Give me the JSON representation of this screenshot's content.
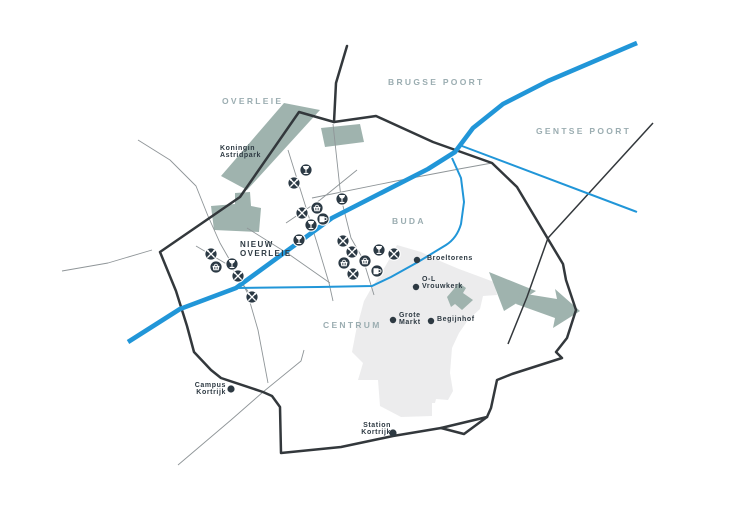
{
  "map": {
    "description": "Stylized district map of Kortrijk with the river Leie, ring roads, parks and points of interest",
    "colors": {
      "bg": "#ffffff",
      "river": "#2196d8",
      "park": "#9fb3ae",
      "ped": "#ececed",
      "road-main": "#33383c",
      "road-thin": "#8f9598",
      "region": "#9badb1",
      "dark": "#2d3942",
      "poi": "#2b3944"
    },
    "regions": [
      {
        "name": "overleie",
        "lines": [
          "OVERLEIE"
        ],
        "x": 222,
        "y": 96,
        "style": "region-label"
      },
      {
        "name": "brugse-poort",
        "lines": [
          "BRUGSE POORT"
        ],
        "x": 388,
        "y": 77,
        "style": "region-label"
      },
      {
        "name": "gentse-poort",
        "lines": [
          "GENTSE POORT"
        ],
        "x": 536,
        "y": 126,
        "style": "region-label"
      },
      {
        "name": "buda",
        "lines": [
          "BUDA"
        ],
        "x": 392,
        "y": 216,
        "style": "region-label"
      },
      {
        "name": "centrum",
        "lines": [
          "CENTRUM"
        ],
        "x": 323,
        "y": 320,
        "style": "region-label"
      },
      {
        "name": "nieuw-overleie",
        "lines": [
          "NIEUW",
          "OVERLEIE"
        ],
        "x": 240,
        "y": 240,
        "style": "district-dark"
      }
    ],
    "landmarks": [
      {
        "name": "koningin-astridpark",
        "lines": [
          "Koningin",
          "Astridpark"
        ],
        "label_x": 220,
        "label_y": 145,
        "align": "left",
        "dot": null
      },
      {
        "name": "broeltorens",
        "lines": [
          "Broeltorens"
        ],
        "label_x": 427,
        "label_y": 255,
        "align": "left",
        "dot": {
          "x": 417,
          "y": 260,
          "r": 3.2
        }
      },
      {
        "name": "o-l-vrouwkerk",
        "lines": [
          "O-L",
          "Vrouwkerk"
        ],
        "label_x": 422,
        "label_y": 276,
        "align": "left",
        "dot": {
          "x": 416,
          "y": 287,
          "r": 3.2
        }
      },
      {
        "name": "grote-markt",
        "lines": [
          "Grote",
          "Markt"
        ],
        "label_x": 399,
        "label_y": 312,
        "align": "left",
        "dot": {
          "x": 393,
          "y": 320,
          "r": 3.2
        }
      },
      {
        "name": "begijnhof",
        "lines": [
          "Begijnhof"
        ],
        "label_x": 437,
        "label_y": 316,
        "align": "left",
        "dot": {
          "x": 431,
          "y": 321,
          "r": 3.2
        }
      },
      {
        "name": "campus-kortrijk",
        "lines": [
          "Campus",
          "Kortrijk"
        ],
        "label_x": 226,
        "label_y": 382,
        "align": "right",
        "dot": {
          "x": 231,
          "y": 389,
          "r": 3.6
        }
      },
      {
        "name": "station-kortrijk",
        "lines": [
          "Station",
          "Kortrijk"
        ],
        "label_x": 391,
        "label_y": 422,
        "align": "right",
        "dot": {
          "x": 393,
          "y": 433,
          "r": 3.6
        }
      }
    ],
    "poi_legend": {
      "restaurant": "crossed-cutlery-icon",
      "bar": "wine-glass-icon",
      "cafe": "beer-mug-icon",
      "shop": "basket-icon"
    },
    "poi_markers": [
      {
        "type": "bar",
        "x": 306,
        "y": 170
      },
      {
        "type": "restaurant",
        "x": 294,
        "y": 183
      },
      {
        "type": "bar",
        "x": 342,
        "y": 199
      },
      {
        "type": "shop",
        "x": 317,
        "y": 208
      },
      {
        "type": "restaurant",
        "x": 302,
        "y": 213
      },
      {
        "type": "cafe",
        "x": 323,
        "y": 219
      },
      {
        "type": "bar",
        "x": 311,
        "y": 225
      },
      {
        "type": "bar",
        "x": 299,
        "y": 240
      },
      {
        "type": "restaurant",
        "x": 211,
        "y": 254
      },
      {
        "type": "bar",
        "x": 232,
        "y": 264
      },
      {
        "type": "shop",
        "x": 216,
        "y": 267
      },
      {
        "type": "restaurant",
        "x": 238,
        "y": 276
      },
      {
        "type": "restaurant",
        "x": 252,
        "y": 297
      },
      {
        "type": "restaurant",
        "x": 343,
        "y": 241
      },
      {
        "type": "restaurant",
        "x": 352,
        "y": 252
      },
      {
        "type": "bar",
        "x": 379,
        "y": 250
      },
      {
        "type": "restaurant",
        "x": 394,
        "y": 254
      },
      {
        "type": "shop",
        "x": 344,
        "y": 263
      },
      {
        "type": "shop",
        "x": 365,
        "y": 261
      },
      {
        "type": "cafe",
        "x": 377,
        "y": 271
      },
      {
        "type": "restaurant",
        "x": 353,
        "y": 274
      }
    ]
  }
}
